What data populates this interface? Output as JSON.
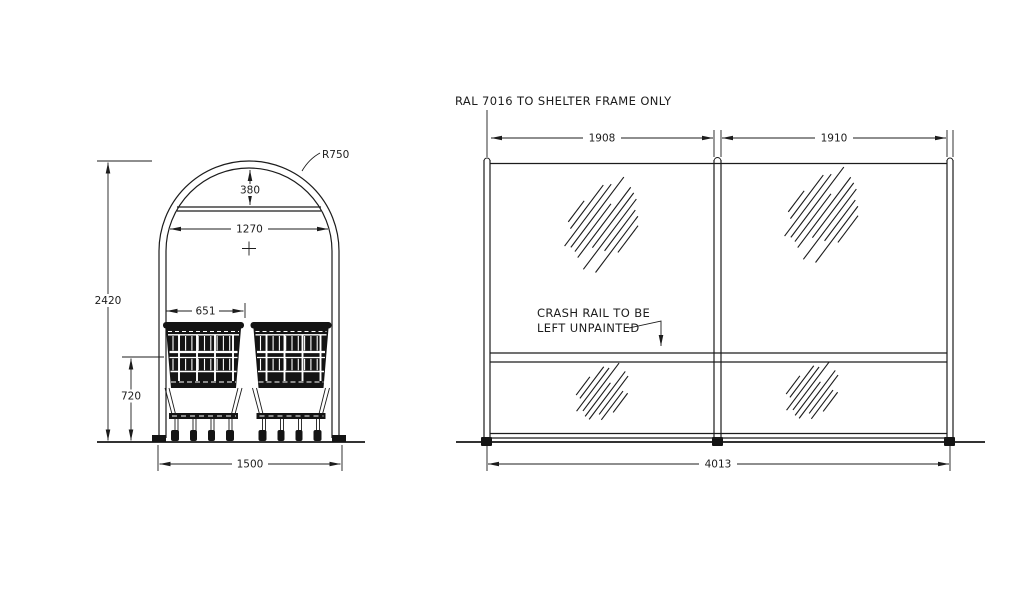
{
  "notes": {
    "frame_finish": "RAL 7016 TO SHELTER FRAME ONLY",
    "crash_rail_line1": "CRASH RAIL TO BE",
    "crash_rail_line2": "LEFT UNPAINTED"
  },
  "end_elevation": {
    "radius": "R750",
    "arch_rise": "380",
    "inner_width": "1270",
    "overall_height": "2420",
    "trolley_width": "651",
    "crash_rail_height": "720",
    "base_width": "1500"
  },
  "side_elevation": {
    "bay_1_width": "1908",
    "bay_2_width": "1910",
    "overall_length": "4013"
  },
  "colors": {
    "line": "#1c1c1c",
    "background": "#ffffff"
  }
}
